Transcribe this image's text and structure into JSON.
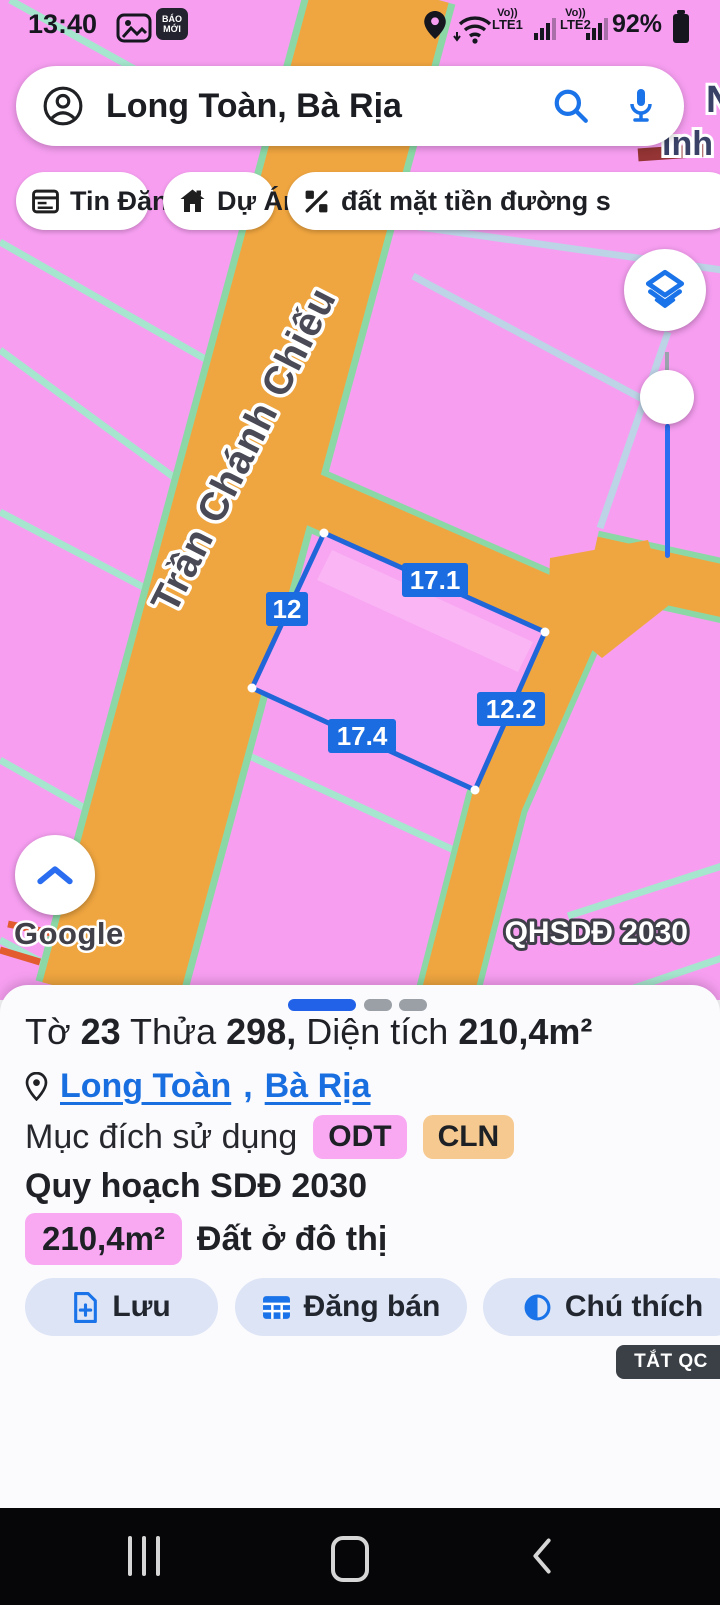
{
  "status_bar": {
    "time": "13:40",
    "baomoi_line1": "BÁO",
    "baomoi_line2": "MỚI",
    "volte1": "Vo))",
    "carrier1": "LTE1",
    "volte2": "Vo))",
    "carrier2": "LTE2",
    "battery_percent": "92%"
  },
  "search": {
    "query": "Long Toàn, Bà Rịa"
  },
  "chips": {
    "items": [
      {
        "label": "Tin Đăng"
      },
      {
        "label": "Dự Án"
      },
      {
        "label": "đất mặt tiền đường s"
      }
    ]
  },
  "map": {
    "street_label": "Trần Chánh Chiếu",
    "watermark": "Google",
    "plan_badge": "QHSDĐ 2030",
    "edge_label_top": "N",
    "edge_label_bottom": "inh",
    "parcel_dims": {
      "top": "17.1",
      "left": "12",
      "right": "12.2",
      "bottom": "17.4"
    },
    "colors": {
      "land": "#f79ef1",
      "road": "#f0a640",
      "road_edge": "#8bd8a6",
      "boundary_teal": "#a6e6cf",
      "boundary_blue": "#bdd3e6",
      "parcel_stroke": "#2166d8",
      "dim_label_bg": "#1a6ce0"
    }
  },
  "sheet": {
    "title_parts": [
      {
        "t": "Tờ "
      },
      {
        "t": "23"
      },
      {
        "t": " Thửa "
      },
      {
        "t": "298,"
      },
      {
        "t": " Diện tích "
      },
      {
        "t": "210,4m²"
      }
    ],
    "location": {
      "link1": "Long Toàn",
      "separator": ", ",
      "link2": "Bà Rịa"
    },
    "purpose_label": "Mục đích sử dụng",
    "badges": [
      {
        "label": "ODT",
        "bg": "#f8a9f2"
      },
      {
        "label": "CLN",
        "bg": "#f5c98f"
      }
    ],
    "plan_line": "Quy hoạch SDĐ 2030",
    "area_badge": "210,4m²",
    "area_text": "Đất ở đô thị",
    "buttons": [
      {
        "label": "Lưu"
      },
      {
        "label": "Đăng bán"
      },
      {
        "label": "Chú thích"
      }
    ],
    "ad_dismiss": "TẮT QC"
  }
}
